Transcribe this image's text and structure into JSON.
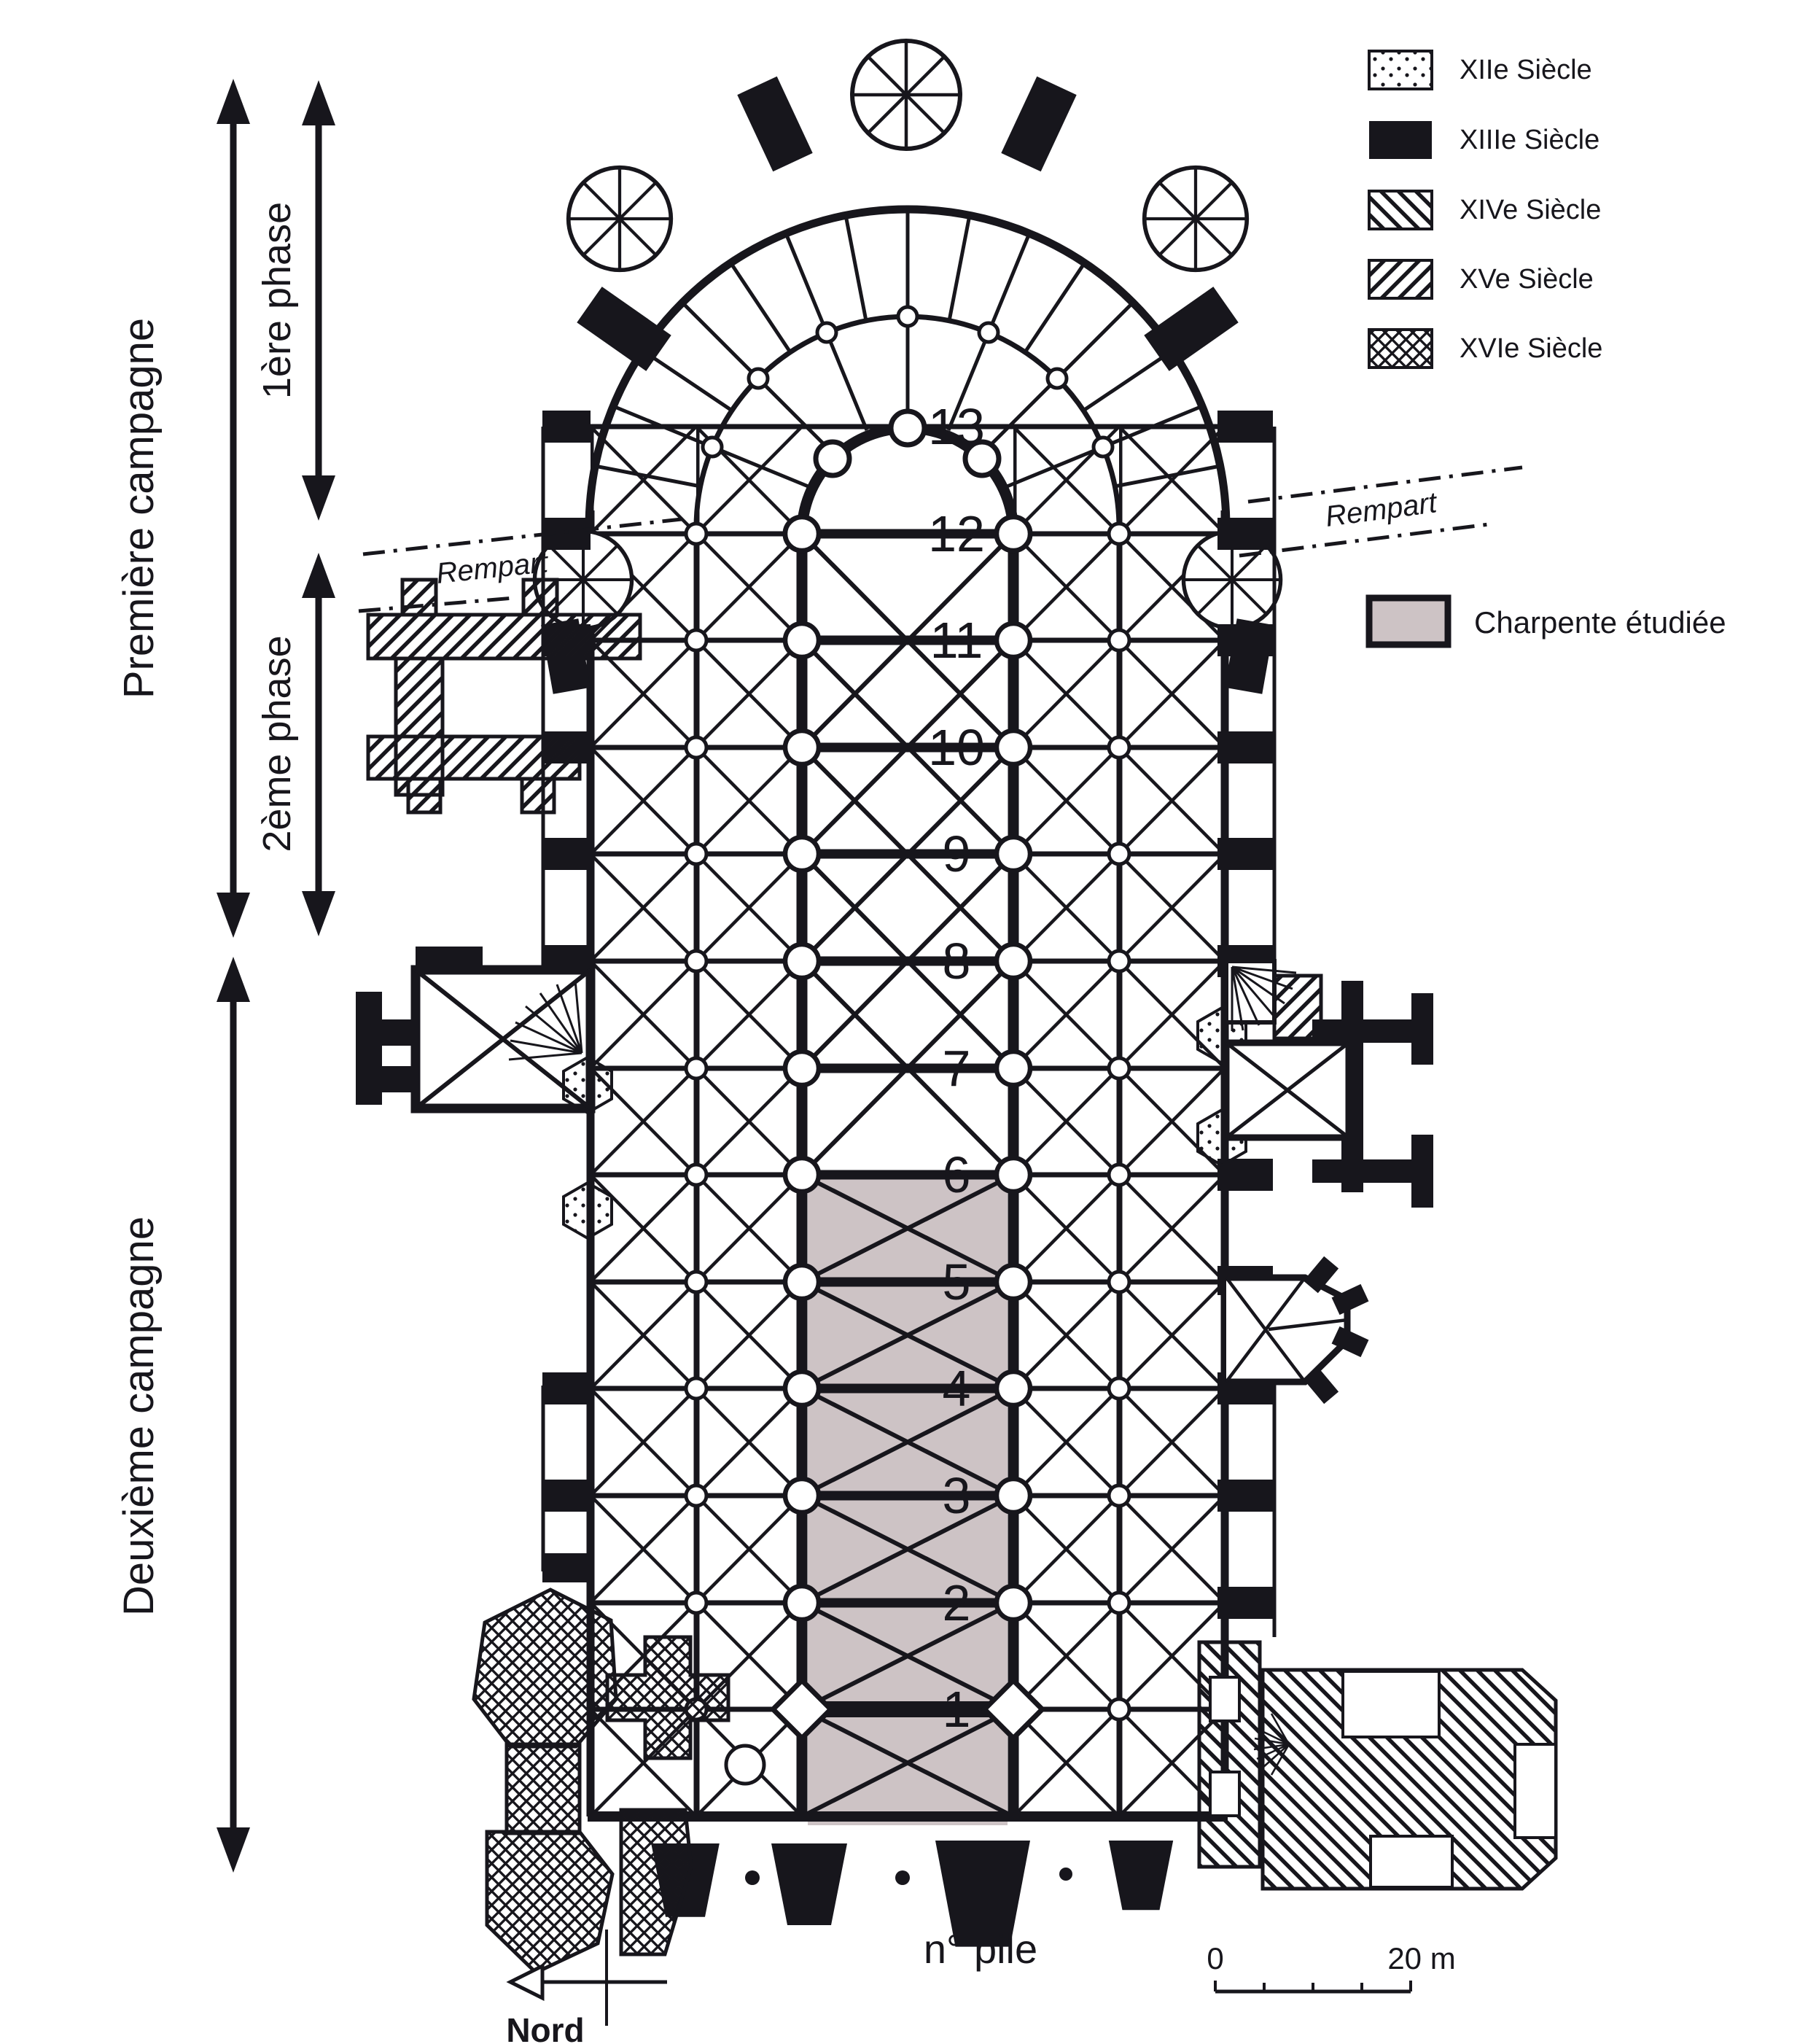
{
  "colors": {
    "ink": "#17161c",
    "paper": "#ffffff",
    "charpente_fill": "#cdc3c5"
  },
  "legend": {
    "items": [
      {
        "id": "xii",
        "pattern": "dots",
        "label": "XIIe Siècle"
      },
      {
        "id": "xiii",
        "pattern": "solid",
        "label": "XIIIe Siècle"
      },
      {
        "id": "xiv",
        "pattern": "diag-back",
        "label": "XIVe Siècle"
      },
      {
        "id": "xv",
        "pattern": "diag-fwd",
        "label": "XVe Siècle"
      },
      {
        "id": "xvi",
        "pattern": "crosshatch",
        "label": "XVIe Siècle"
      }
    ],
    "charpente_label": "Charpente étudiée"
  },
  "campaigns": {
    "premiere": "Première campagne",
    "phase1": "1ère phase",
    "phase2": "2ème phase",
    "deuxieme": "Deuxième campagne"
  },
  "plan": {
    "rempart_left": "Rempart",
    "rempart_right": "Rempart",
    "pier_numbers": [
      "13",
      "12",
      "11",
      "10",
      "9",
      "8",
      "7",
      "6",
      "5",
      "4",
      "3",
      "2",
      "1"
    ]
  },
  "footer": {
    "pile_label": "n° pile",
    "north_label": "Nord",
    "scale_start": "0",
    "scale_end": "20 m"
  }
}
